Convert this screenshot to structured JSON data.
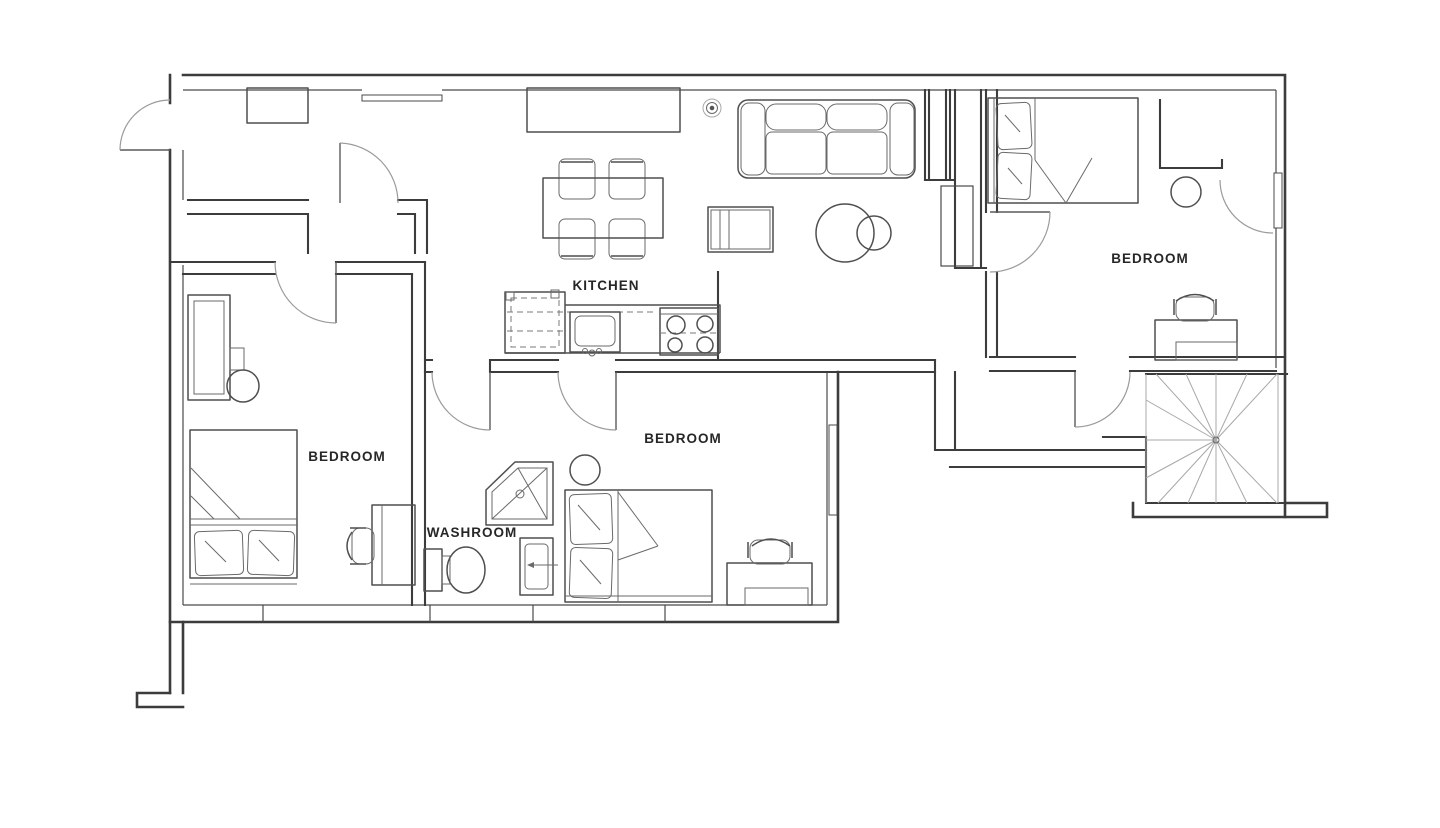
{
  "plan": {
    "type": "apartment-floor-plan",
    "rooms": [
      {
        "name": "kitchen",
        "label": "KITCHEN",
        "label_x": 606,
        "label_y": 290
      },
      {
        "name": "washroom",
        "label": "WASHROOM",
        "label_x": 472,
        "label_y": 537
      },
      {
        "name": "bedroom-bottom-left",
        "label": "BEDROOM",
        "label_x": 347,
        "label_y": 461
      },
      {
        "name": "bedroom-middle",
        "label": "BEDROOM",
        "label_x": 683,
        "label_y": 443
      },
      {
        "name": "bedroom-top-right",
        "label": "BEDROOM",
        "label_x": 1150,
        "label_y": 263
      }
    ],
    "colors": {
      "background": "#ffffff",
      "walls": "#3c3c3c",
      "furniture": "#4f4f4f",
      "door_arcs": "#9b9b9b",
      "stair_treads": "#a8a8a8",
      "labels": "#262626"
    },
    "furniture": [
      "entry-door",
      "sofa",
      "tv-stand",
      "round-table",
      "stool",
      "ceiling-light",
      "dining-table",
      "dining-chairs",
      "sideboard",
      "wall-cabinet",
      "refrigerator",
      "kitchen-counter",
      "kitchen-sink",
      "stove",
      "double-bed",
      "single-bed",
      "pillows",
      "desk",
      "desk-chair",
      "wardrobe",
      "side-table",
      "shower",
      "toilet",
      "washroom-sink",
      "winder-staircase",
      "windows"
    ]
  }
}
